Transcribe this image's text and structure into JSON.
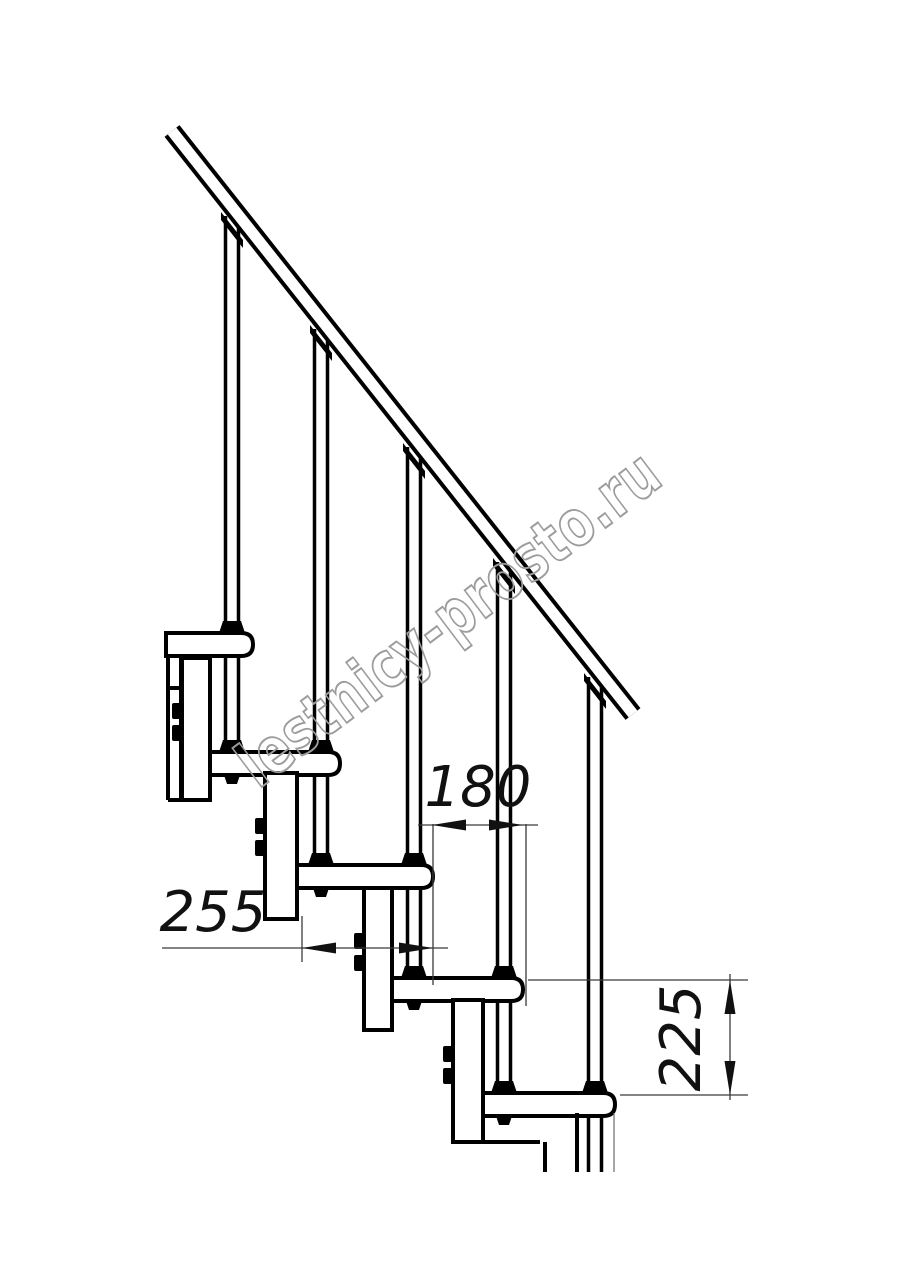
{
  "drawing": {
    "watermark": "lestnicy-prosto.ru",
    "dimensions": {
      "step_length_label": "255",
      "step_run_label": "180",
      "step_rise_label": "225"
    }
  }
}
